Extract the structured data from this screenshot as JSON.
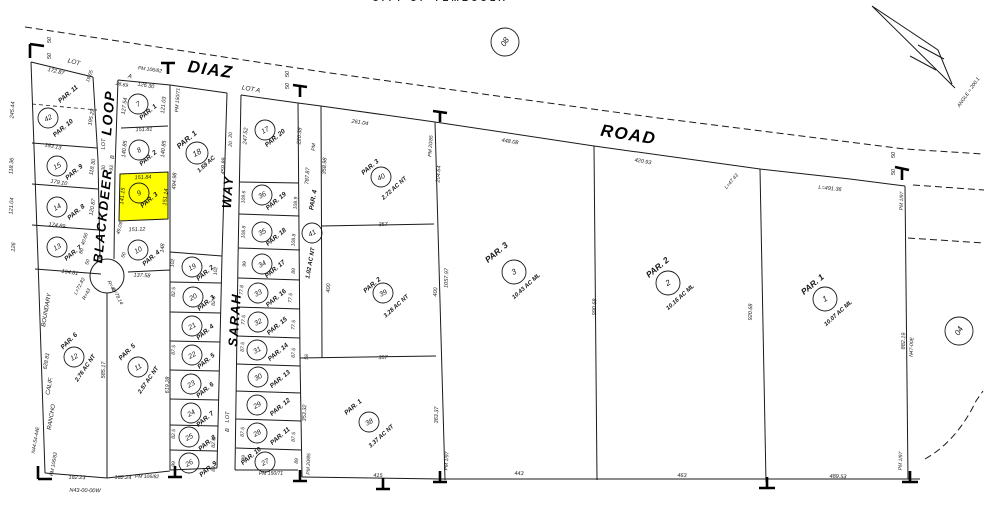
{
  "header": {
    "title": "CITY OF TEMECULA"
  },
  "colors": {
    "highlight": "#FFFF00",
    "ink": "#1A1A1A",
    "paper": "#FFFFFF"
  },
  "streets": [
    {
      "name": "DIAZ",
      "x": 210,
      "y": 73,
      "r": 8,
      "s": 17
    },
    {
      "name": "ROAD",
      "x": 628,
      "y": 138,
      "r": 9,
      "s": 17
    },
    {
      "name": "LOOP",
      "x": 111,
      "y": 113,
      "r": -85,
      "s": 14
    },
    {
      "name": "BLACKDEER",
      "x": 105,
      "y": 216,
      "r": -84,
      "s": 13
    },
    {
      "name": "SARAH",
      "x": 237,
      "y": 320,
      "r": -86,
      "s": 13
    },
    {
      "name": "WAY",
      "x": 230,
      "y": 192,
      "r": -86,
      "s": 13
    }
  ],
  "parcel_circles": [
    {
      "n": "42",
      "x": 48,
      "y": 118
    },
    {
      "n": "15",
      "x": 57,
      "y": 166
    },
    {
      "n": "14",
      "x": 57,
      "y": 207
    },
    {
      "n": "13",
      "x": 57,
      "y": 247
    },
    {
      "n": "12",
      "x": 74,
      "y": 357
    },
    {
      "n": "11",
      "x": 138,
      "y": 367
    },
    {
      "n": "7",
      "x": 138,
      "y": 104
    },
    {
      "n": "8",
      "x": 139,
      "y": 150
    },
    {
      "n": "9",
      "x": 139,
      "y": 193
    },
    {
      "n": "10",
      "x": 138,
      "y": 250
    },
    {
      "n": "18",
      "x": 197,
      "y": 153,
      "rad": 11
    },
    {
      "n": "19",
      "x": 192,
      "y": 267
    },
    {
      "n": "20",
      "x": 193,
      "y": 297
    },
    {
      "n": "21",
      "x": 192,
      "y": 326
    },
    {
      "n": "22",
      "x": 192,
      "y": 355
    },
    {
      "n": "23",
      "x": 191,
      "y": 384
    },
    {
      "n": "24",
      "x": 191,
      "y": 413
    },
    {
      "n": "25",
      "x": 189,
      "y": 437
    },
    {
      "n": "26",
      "x": 189,
      "y": 463
    },
    {
      "n": "17",
      "x": 265,
      "y": 130
    },
    {
      "n": "36",
      "x": 262,
      "y": 195
    },
    {
      "n": "35",
      "x": 262,
      "y": 232
    },
    {
      "n": "34",
      "x": 262,
      "y": 264
    },
    {
      "n": "33",
      "x": 258,
      "y": 293
    },
    {
      "n": "32",
      "x": 258,
      "y": 322
    },
    {
      "n": "31",
      "x": 257,
      "y": 350
    },
    {
      "n": "30",
      "x": 258,
      "y": 377
    },
    {
      "n": "29",
      "x": 257,
      "y": 405
    },
    {
      "n": "28",
      "x": 257,
      "y": 433
    },
    {
      "n": "27",
      "x": 265,
      "y": 462
    },
    {
      "n": "41",
      "x": 312,
      "y": 233
    },
    {
      "n": "40",
      "x": 381,
      "y": 177
    },
    {
      "n": "39",
      "x": 383,
      "y": 293
    },
    {
      "n": "38",
      "x": 369,
      "y": 422
    },
    {
      "n": "3",
      "x": 514,
      "y": 272,
      "rad": 12
    },
    {
      "n": "2",
      "x": 668,
      "y": 283,
      "rad": 12
    },
    {
      "n": "1",
      "x": 825,
      "y": 299,
      "rad": 12
    },
    {
      "n": "08",
      "x": 505,
      "y": 42,
      "rad": 14,
      "sec": true
    },
    {
      "n": "04",
      "x": 959,
      "y": 331,
      "rad": 14,
      "sec": true
    }
  ],
  "parcel_labels": [
    {
      "t": "PAR. 11",
      "x": 68,
      "y": 94
    },
    {
      "t": "PAR. 10",
      "x": 63,
      "y": 128
    },
    {
      "t": "PAR. 9",
      "x": 74,
      "y": 172
    },
    {
      "t": "PAR. 8",
      "x": 76,
      "y": 212
    },
    {
      "t": "PAR. 7",
      "x": 73,
      "y": 253
    },
    {
      "t": "PAR. 6",
      "x": 69,
      "y": 341,
      "r": -45
    },
    {
      "t": "PAR. 5",
      "x": 127,
      "y": 352,
      "r": -45
    },
    {
      "t": "PAR. 1",
      "x": 148,
      "y": 112
    },
    {
      "t": "PAR. 2",
      "x": 148,
      "y": 158
    },
    {
      "t": "PAR. 3",
      "x": 149,
      "y": 200
    },
    {
      "t": "PAR. 4",
      "x": 151,
      "y": 258
    },
    {
      "t": "PAR. 1",
      "x": 187,
      "y": 140,
      "s": 7.5
    },
    {
      "t": "PAR. 2",
      "x": 205,
      "y": 273
    },
    {
      "t": "PAR. 3",
      "x": 206,
      "y": 303
    },
    {
      "t": "PAR. 4",
      "x": 205,
      "y": 332
    },
    {
      "t": "PAR. 5",
      "x": 206,
      "y": 361
    },
    {
      "t": "PAR. 6",
      "x": 205,
      "y": 390
    },
    {
      "t": "PAR. 7",
      "x": 205,
      "y": 419
    },
    {
      "t": "PAR. 8",
      "x": 207,
      "y": 443
    },
    {
      "t": "PAR. 9",
      "x": 208,
      "y": 469
    },
    {
      "t": "PAR. 20",
      "x": 275,
      "y": 138
    },
    {
      "t": "PAR. 19",
      "x": 276,
      "y": 201
    },
    {
      "t": "PAR. 18",
      "x": 276,
      "y": 237
    },
    {
      "t": "PAR. 17",
      "x": 275,
      "y": 269
    },
    {
      "t": "PAR. 16",
      "x": 276,
      "y": 298
    },
    {
      "t": "PAR. 15",
      "x": 277,
      "y": 326
    },
    {
      "t": "PAR. 14",
      "x": 278,
      "y": 352
    },
    {
      "t": "PAR. 13",
      "x": 280,
      "y": 379
    },
    {
      "t": "PAR. 12",
      "x": 280,
      "y": 407
    },
    {
      "t": "PAR. 11",
      "x": 280,
      "y": 436
    },
    {
      "t": "PAR. 10",
      "x": 251,
      "y": 456
    },
    {
      "t": "PAR. 4",
      "x": 313,
      "y": 200,
      "r": -80
    },
    {
      "t": "PAR. 3",
      "x": 370,
      "y": 167
    },
    {
      "t": "PAR. 2",
      "x": 372,
      "y": 285
    },
    {
      "t": "PAR. 1",
      "x": 353,
      "y": 407
    },
    {
      "t": "PAR. 3",
      "x": 497,
      "y": 253,
      "s": 8.5
    },
    {
      "t": "PAR. 2",
      "x": 658,
      "y": 268,
      "s": 8.5
    },
    {
      "t": "PAR. 1",
      "x": 813,
      "y": 285,
      "s": 8.5
    }
  ],
  "acreage_labels": [
    {
      "t": "1.69 AC",
      "x": 206,
      "y": 164
    },
    {
      "t": "2.76 AC NT",
      "x": 85,
      "y": 368,
      "r": -55
    },
    {
      "t": "2.57 AC NT",
      "x": 148,
      "y": 380,
      "r": -55
    },
    {
      "t": "1.02 AC NT",
      "x": 310,
      "y": 263,
      "r": -80
    },
    {
      "t": "2.72 AC NT",
      "x": 394,
      "y": 188
    },
    {
      "t": "3.28 AC NT",
      "x": 396,
      "y": 306
    },
    {
      "t": "3.37 AC NT",
      "x": 381,
      "y": 436
    },
    {
      "t": "10.43 AC ML",
      "x": 526,
      "y": 286
    },
    {
      "t": "10.16 AC ML",
      "x": 680,
      "y": 297
    },
    {
      "t": "10.07 AC ML",
      "x": 838,
      "y": 313
    }
  ],
  "dimension_labels": [
    {
      "t": "172.87",
      "x": 56,
      "y": 71,
      "r": 14
    },
    {
      "t": "19.05",
      "x": 89,
      "y": 76,
      "r": -70,
      "s": 5
    },
    {
      "t": "245.44",
      "x": 12,
      "y": 110,
      "r": -86
    },
    {
      "t": "195.29",
      "x": 91,
      "y": 117,
      "r": -80
    },
    {
      "t": "183.13",
      "x": 53,
      "y": 146,
      "r": 12
    },
    {
      "t": "118.36",
      "x": 11,
      "y": 166,
      "r": -86
    },
    {
      "t": "118.30",
      "x": 92,
      "y": 167,
      "r": -80
    },
    {
      "t": "179.10",
      "x": 59,
      "y": 182,
      "r": 10
    },
    {
      "t": "121.04",
      "x": 11,
      "y": 206,
      "r": -86
    },
    {
      "t": "120.87",
      "x": 92,
      "y": 207,
      "r": -80
    },
    {
      "t": "174.89",
      "x": 57,
      "y": 225,
      "r": 8
    },
    {
      "t": "126",
      "x": 13,
      "y": 247,
      "r": -86
    },
    {
      "t": "40.66",
      "x": 84,
      "y": 239,
      "r": -72,
      "s": 5
    },
    {
      "t": "80",
      "x": 81,
      "y": 251,
      "r": -72,
      "s": 5
    },
    {
      "t": "50",
      "x": 87,
      "y": 262,
      "r": -72,
      "s": 5
    },
    {
      "t": "164.81",
      "x": 70,
      "y": 272,
      "r": 8
    },
    {
      "t": "585.17",
      "x": 103,
      "y": 370,
      "r": -88
    },
    {
      "t": "619.28",
      "x": 167,
      "y": 385,
      "r": -88
    },
    {
      "t": "628.81",
      "x": 46,
      "y": 361,
      "r": -80
    },
    {
      "t": "182.23",
      "x": 77,
      "y": 477,
      "r": 1
    },
    {
      "t": "182.24",
      "x": 123,
      "y": 477,
      "r": 1
    },
    {
      "t": "26.69",
      "x": 122,
      "y": 84,
      "r": 12,
      "s": 5
    },
    {
      "t": "126.30",
      "x": 146,
      "y": 85,
      "r": 10
    },
    {
      "t": "127.54",
      "x": 124,
      "y": 106,
      "r": -82
    },
    {
      "t": "121.03",
      "x": 163,
      "y": 105,
      "r": -84
    },
    {
      "t": "151.81",
      "x": 144,
      "y": 129,
      "r": -2
    },
    {
      "t": "140.85",
      "x": 124,
      "y": 149,
      "r": -84
    },
    {
      "t": "140.85",
      "x": 163,
      "y": 149,
      "r": -84
    },
    {
      "t": "151.84",
      "x": 143,
      "y": 177,
      "r": -2
    },
    {
      "t": "141.15",
      "x": 122,
      "y": 196,
      "r": -84
    },
    {
      "t": "151.14",
      "x": 165,
      "y": 197,
      "r": -84
    },
    {
      "t": "151.12",
      "x": 137,
      "y": 229,
      "r": -2
    },
    {
      "t": "49.09",
      "x": 119,
      "y": 228,
      "r": -75,
      "s": 5
    },
    {
      "t": "148",
      "x": 162,
      "y": 248,
      "r": -84
    },
    {
      "t": "50",
      "x": 123,
      "y": 255,
      "r": -70,
      "s": 5
    },
    {
      "t": "137.58",
      "x": 142,
      "y": 275,
      "r": 3
    },
    {
      "t": "L=72.83",
      "x": 79,
      "y": 286,
      "r": -62,
      "s": 5
    },
    {
      "t": "R=43",
      "x": 86,
      "y": 294,
      "r": -62,
      "s": 5
    },
    {
      "t": "R=48",
      "x": 112,
      "y": 286,
      "r": 62,
      "s": 5
    },
    {
      "t": "L=78.14",
      "x": 118,
      "y": 296,
      "r": 62,
      "s": 5
    },
    {
      "t": "30",
      "x": 103,
      "y": 168,
      "r": -86,
      "s": 5
    },
    {
      "t": "93",
      "x": 111,
      "y": 168,
      "r": -86,
      "s": 5
    },
    {
      "t": "50",
      "x": 49,
      "y": 40,
      "r": -90,
      "s": 5.5
    },
    {
      "t": "50",
      "x": 49,
      "y": 56,
      "r": -90,
      "s": 5.5
    },
    {
      "t": "494.98",
      "x": 174,
      "y": 181,
      "r": -87
    },
    {
      "t": "459.89",
      "x": 223,
      "y": 166,
      "r": -87
    },
    {
      "t": "20",
      "x": 230,
      "y": 135,
      "r": -86,
      "s": 5
    },
    {
      "t": "20",
      "x": 230,
      "y": 144,
      "r": -86,
      "s": 5
    },
    {
      "t": "50",
      "x": 287,
      "y": 74,
      "r": -90,
      "s": 5.5
    },
    {
      "t": "50",
      "x": 287,
      "y": 86,
      "r": -90,
      "s": 5.5
    },
    {
      "t": "247.52",
      "x": 245,
      "y": 136,
      "r": -86
    },
    {
      "t": "220.38",
      "x": 299,
      "y": 136,
      "r": -86
    },
    {
      "t": "109.6",
      "x": 243,
      "y": 197,
      "r": -86,
      "s": 5
    },
    {
      "t": "108.9",
      "x": 295,
      "y": 203,
      "r": -86,
      "s": 5
    },
    {
      "t": "108.8",
      "x": 243,
      "y": 232,
      "r": -86,
      "s": 5
    },
    {
      "t": "108.8",
      "x": 293,
      "y": 240,
      "r": -86,
      "s": 5
    },
    {
      "t": "99",
      "x": 244,
      "y": 264,
      "r": -86,
      "s": 5
    },
    {
      "t": "89",
      "x": 293,
      "y": 271,
      "r": -86,
      "s": 5
    },
    {
      "t": "77.8",
      "x": 241,
      "y": 290,
      "r": -86,
      "s": 5
    },
    {
      "t": "77.5",
      "x": 290,
      "y": 298,
      "r": -86,
      "s": 5
    },
    {
      "t": "77.5",
      "x": 243,
      "y": 320,
      "r": -86,
      "s": 5
    },
    {
      "t": "77.5",
      "x": 293,
      "y": 325,
      "r": -86,
      "s": 5
    },
    {
      "t": "87.5",
      "x": 242,
      "y": 347,
      "r": -86,
      "s": 5
    },
    {
      "t": "87.5",
      "x": 293,
      "y": 353,
      "r": -86,
      "s": 5
    },
    {
      "t": "58",
      "x": 306,
      "y": 357,
      "r": -86,
      "s": 5
    },
    {
      "t": "87.5",
      "x": 242,
      "y": 432,
      "r": -86,
      "s": 5
    },
    {
      "t": "87.5",
      "x": 293,
      "y": 437,
      "r": -86,
      "s": 5
    },
    {
      "t": "99",
      "x": 243,
      "y": 458,
      "r": -86,
      "s": 5
    },
    {
      "t": "89",
      "x": 296,
      "y": 461,
      "r": -86,
      "s": 5
    },
    {
      "t": "353.32",
      "x": 304,
      "y": 413,
      "r": -88
    },
    {
      "t": "102",
      "x": 172,
      "y": 263,
      "r": -86,
      "s": 5
    },
    {
      "t": "102",
      "x": 215,
      "y": 271,
      "r": -86,
      "s": 5
    },
    {
      "t": "82.5",
      "x": 173,
      "y": 292,
      "r": -86,
      "s": 5
    },
    {
      "t": "82.5",
      "x": 213,
      "y": 301,
      "r": -86,
      "s": 5
    },
    {
      "t": "87.5",
      "x": 173,
      "y": 350,
      "r": -86,
      "s": 5
    },
    {
      "t": "82.5",
      "x": 173,
      "y": 434,
      "r": -86,
      "s": 5
    },
    {
      "t": "82.5",
      "x": 213,
      "y": 443,
      "r": -86,
      "s": 5
    },
    {
      "t": "99",
      "x": 173,
      "y": 464,
      "r": -86,
      "s": 5
    },
    {
      "t": "89",
      "x": 213,
      "y": 469,
      "r": -86,
      "s": 5
    },
    {
      "t": "787.87",
      "x": 307,
      "y": 176,
      "r": -86
    },
    {
      "t": "358.98",
      "x": 324,
      "y": 166,
      "r": -86
    },
    {
      "t": "261.04",
      "x": 360,
      "y": 122,
      "r": 9
    },
    {
      "t": "204.64",
      "x": 438,
      "y": 174,
      "r": -86
    },
    {
      "t": "357",
      "x": 383,
      "y": 224,
      "r": -2
    },
    {
      "t": "400",
      "x": 328,
      "y": 288,
      "r": -86
    },
    {
      "t": "400",
      "x": 435,
      "y": 292,
      "r": -86
    },
    {
      "t": "1057.97",
      "x": 446,
      "y": 278,
      "r": -88
    },
    {
      "t": "357",
      "x": 383,
      "y": 357,
      "r": -2
    },
    {
      "t": "363.37",
      "x": 436,
      "y": 415,
      "r": -88
    },
    {
      "t": "415",
      "x": 378,
      "y": 475,
      "r": 1
    },
    {
      "t": "443",
      "x": 519,
      "y": 473,
      "r": 1
    },
    {
      "t": "463",
      "x": 682,
      "y": 475,
      "r": 1
    },
    {
      "t": "489.53",
      "x": 838,
      "y": 476,
      "r": 2
    },
    {
      "t": "448.08",
      "x": 510,
      "y": 141,
      "r": 9
    },
    {
      "t": "420.93",
      "x": 643,
      "y": 161,
      "r": 10
    },
    {
      "t": "990.68",
      "x": 594,
      "y": 307,
      "r": -88
    },
    {
      "t": "920.68",
      "x": 750,
      "y": 312,
      "r": -88
    },
    {
      "t": "L=47.43",
      "x": 731,
      "y": 181,
      "r": -50,
      "s": 5
    },
    {
      "t": "L=491.36",
      "x": 830,
      "y": 188,
      "r": 6
    },
    {
      "t": "882.19",
      "x": 903,
      "y": 341,
      "r": -88
    },
    {
      "t": "50",
      "x": 893,
      "y": 155,
      "r": -90,
      "s": 5.5
    },
    {
      "t": "50",
      "x": 893,
      "y": 172,
      "r": -90,
      "s": 5.5
    }
  ],
  "reference_labels": [
    {
      "t": "LOT",
      "x": 74,
      "y": 62,
      "r": 14,
      "s": 6.5
    },
    {
      "t": "PM 106/82",
      "x": 150,
      "y": 69,
      "r": 8,
      "s": 5
    },
    {
      "t": "A",
      "x": 130,
      "y": 76,
      "r": 10,
      "s": 6
    },
    {
      "t": "LOT",
      "x": 103,
      "y": 144,
      "r": -86,
      "s": 5.5
    },
    {
      "t": "B",
      "x": 112,
      "y": 157,
      "r": -86,
      "s": 5.5
    },
    {
      "t": "LOT A",
      "x": 251,
      "y": 89,
      "r": 10,
      "s": 6.5
    },
    {
      "t": "PM 150/71",
      "x": 177,
      "y": 100,
      "r": -86,
      "s": 5
    },
    {
      "t": "PM",
      "x": 313,
      "y": 147,
      "r": -86,
      "s": 5
    },
    {
      "t": "PM 20/85",
      "x": 430,
      "y": 146,
      "r": -86,
      "s": 5
    },
    {
      "t": "PM 150/71",
      "x": 271,
      "y": 473,
      "r": 0,
      "s": 5
    },
    {
      "t": "PM 20/85",
      "x": 308,
      "y": 464,
      "r": -88,
      "s": 5
    },
    {
      "t": "LOT",
      "x": 227,
      "y": 417,
      "r": -86,
      "s": 5.5
    },
    {
      "t": "B",
      "x": 227,
      "y": 430,
      "r": -86,
      "s": 5.5
    },
    {
      "t": "BOUNDARY",
      "x": 46,
      "y": 310,
      "r": -80,
      "s": 6
    },
    {
      "t": "CALIF.",
      "x": 49,
      "y": 386,
      "r": -80,
      "s": 6
    },
    {
      "t": "RANCHO",
      "x": 51,
      "y": 417,
      "r": -80,
      "s": 6
    },
    {
      "t": "N44-54-44E",
      "x": 35,
      "y": 440,
      "r": -80,
      "s": 5
    },
    {
      "t": "PM 106/82",
      "x": 53,
      "y": 464,
      "r": -80,
      "s": 5
    },
    {
      "t": "PM 106/82",
      "x": 147,
      "y": 476,
      "r": 1,
      "s": 5
    },
    {
      "t": "N43-00-00W",
      "x": 85,
      "y": 490,
      "r": 1,
      "s": 5.5
    },
    {
      "t": "PM 1/97",
      "x": 901,
      "y": 201,
      "r": -88,
      "s": 5
    },
    {
      "t": "PM 1/97",
      "x": 446,
      "y": 461,
      "r": -86,
      "s": 5
    },
    {
      "t": "PM 1/97",
      "x": 900,
      "y": 461,
      "r": -88,
      "s": 5
    },
    {
      "t": "N47-00E",
      "x": 911,
      "y": 347,
      "r": -88,
      "s": 5
    },
    {
      "t": "ANGLE = 200.1",
      "x": 968,
      "y": 92,
      "r": -55,
      "s": 5
    }
  ]
}
